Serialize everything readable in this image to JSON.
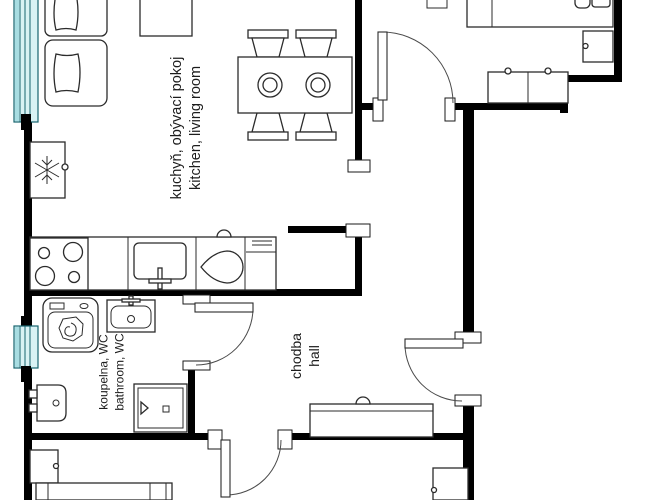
{
  "colors": {
    "wall": "#000000",
    "line": "#2b2b2b",
    "window_fill": "#d9f2f4",
    "window_stroke": "#16646e",
    "window_stripe": "#a8dde2",
    "background": "#ffffff",
    "text": "#1c1c1c"
  },
  "rooms": {
    "kitchen_living": {
      "czech": "kuchyň, obývací pokoj",
      "english": "kitchen, living room"
    },
    "bathroom": {
      "czech": "koupelna, WC",
      "english": "bathroom, WC"
    },
    "hall": {
      "czech": "chodba",
      "english": "hall"
    }
  },
  "furniture": {
    "kitchen_living": [
      "sofa",
      "side table",
      "dining table",
      "four chairs",
      "two plates",
      "fridge",
      "stove",
      "kitchen sink",
      "basin",
      "kitchen cabinet"
    ],
    "bedroom_top_right": [
      "bed",
      "nightstand",
      "wardrobe"
    ],
    "bathroom": [
      "washing machine",
      "sink",
      "toilet",
      "shower"
    ],
    "hall": [
      "sideboard"
    ],
    "bottom_rooms": [
      "nightstand",
      "bed",
      "cabinet"
    ]
  },
  "windows": {
    "count": 2
  }
}
